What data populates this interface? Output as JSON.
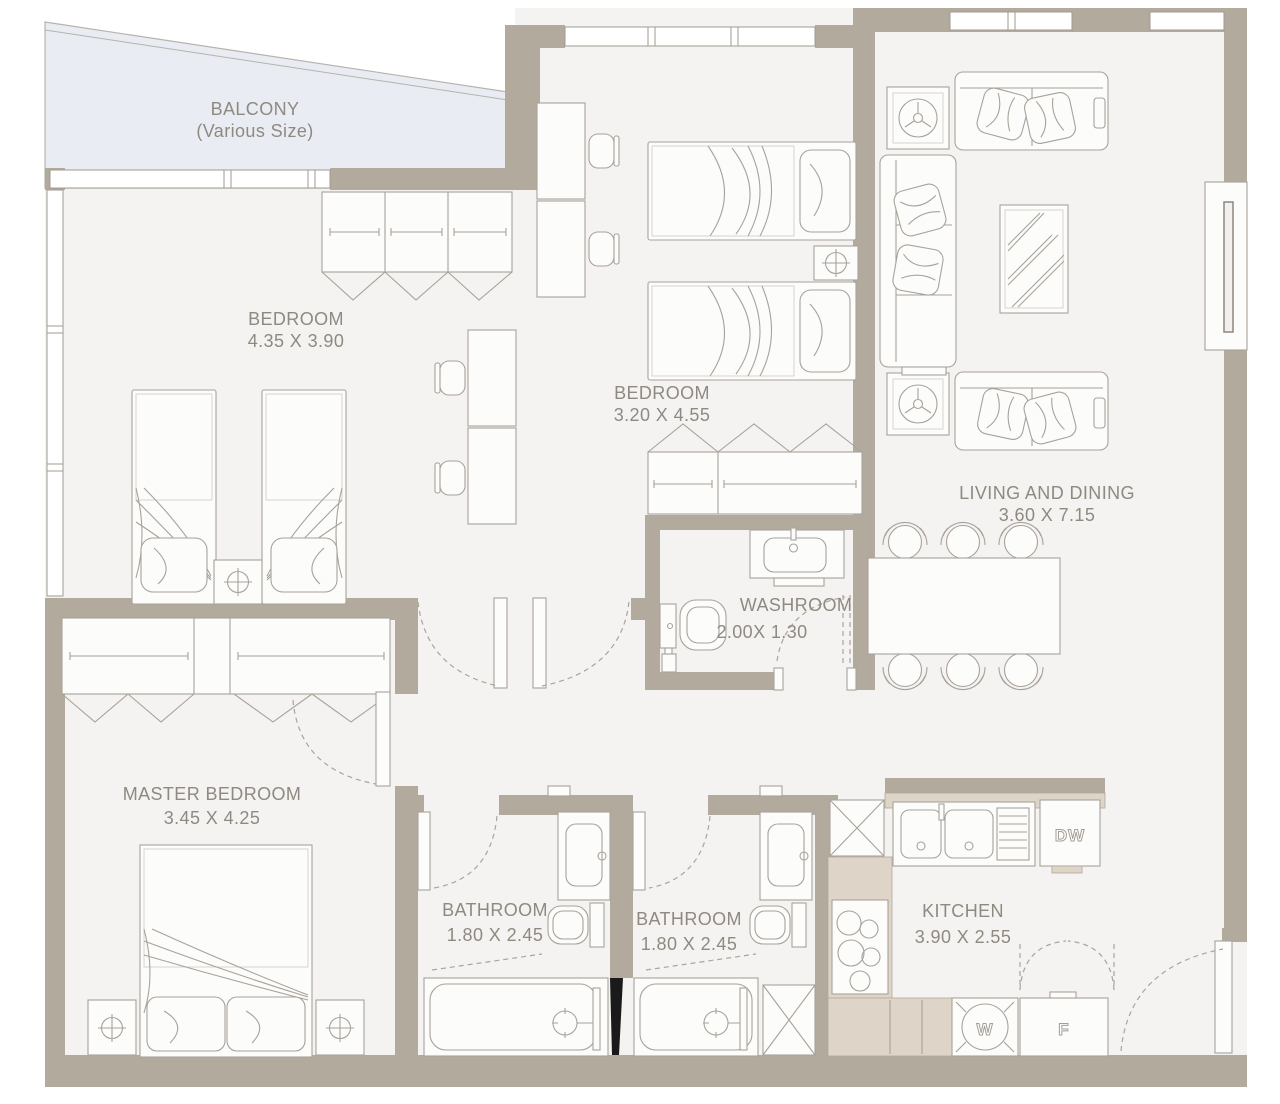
{
  "plan": {
    "rooms": {
      "balcony": {
        "name": "BALCONY",
        "size": "(Various Size)"
      },
      "bedroom1": {
        "name": "BEDROOM",
        "size": "4.35 X 3.90"
      },
      "bedroom2": {
        "name": "BEDROOM",
        "size": "3.20 X 4.55"
      },
      "living": {
        "name": "LIVING AND DINING",
        "size": "3.60 X 7.15"
      },
      "washroom": {
        "name": "WASHROOM",
        "size": "2.00X 1.30"
      },
      "master": {
        "name": "MASTER BEDROOM",
        "size": "3.45 X 4.25"
      },
      "bathroom1": {
        "name": "BATHROOM",
        "size": "1.80 X 2.45"
      },
      "bathroom2": {
        "name": "BATHROOM",
        "size": "1.80 X 2.45"
      },
      "kitchen": {
        "name": "KITCHEN",
        "size": "3.90 X 2.55"
      }
    },
    "appliances": {
      "dishwasher": "DW",
      "washer": "W",
      "fridge": "F"
    },
    "colors": {
      "wall": "#b3aa9e",
      "floor": "#f4f3f1",
      "balcony": "#e9ecf2",
      "counter": "#ded5c8",
      "line": "#a8a29a",
      "label": "#8f8a81"
    }
  }
}
